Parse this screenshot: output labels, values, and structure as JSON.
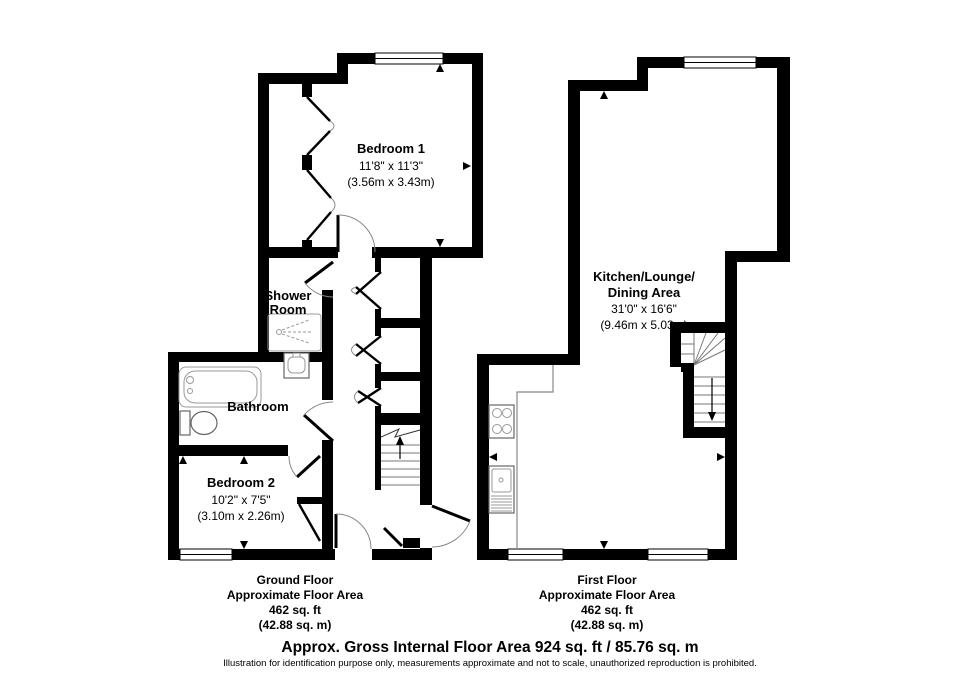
{
  "ground_floor": {
    "rooms": {
      "bedroom1": {
        "name": "Bedroom 1",
        "size_imperial": "11'8\" x 11'3\"",
        "size_metric": "(3.56m x 3.43m)"
      },
      "shower_room": {
        "name_line1": "Shower",
        "name_line2": "Room"
      },
      "bathroom": {
        "name": "Bathroom"
      },
      "bedroom2": {
        "name": "Bedroom 2",
        "size_imperial": "10'2\" x 7'5\"",
        "size_metric": "(3.10m x 2.26m)"
      }
    },
    "caption": {
      "title": "Ground Floor",
      "line2": "Approximate Floor Area",
      "line3": "462 sq. ft",
      "line4": "(42.88 sq. m)"
    }
  },
  "first_floor": {
    "rooms": {
      "kitchen_lounge_dining": {
        "name_line1": "Kitchen/Lounge/",
        "name_line2": "Dining Area",
        "size_imperial": "31'0\" x 16'6\"",
        "size_metric": "(9.46m x 5.03m)"
      }
    },
    "caption": {
      "title": "First Floor",
      "line2": "Approximate Floor Area",
      "line3": "462 sq. ft",
      "line4": "(42.88 sq. m)"
    }
  },
  "footer": {
    "total_area": "Approx. Gross Internal Floor Area 924 sq. ft / 85.76 sq. m",
    "disclaimer": "Illustration for identification purpose only, measurements approximate and not to scale, unauthorized reproduction is prohibited."
  },
  "colors": {
    "wall": "#000000",
    "background": "#ffffff",
    "fixture_outline": "#888888",
    "text": "#000000"
  }
}
